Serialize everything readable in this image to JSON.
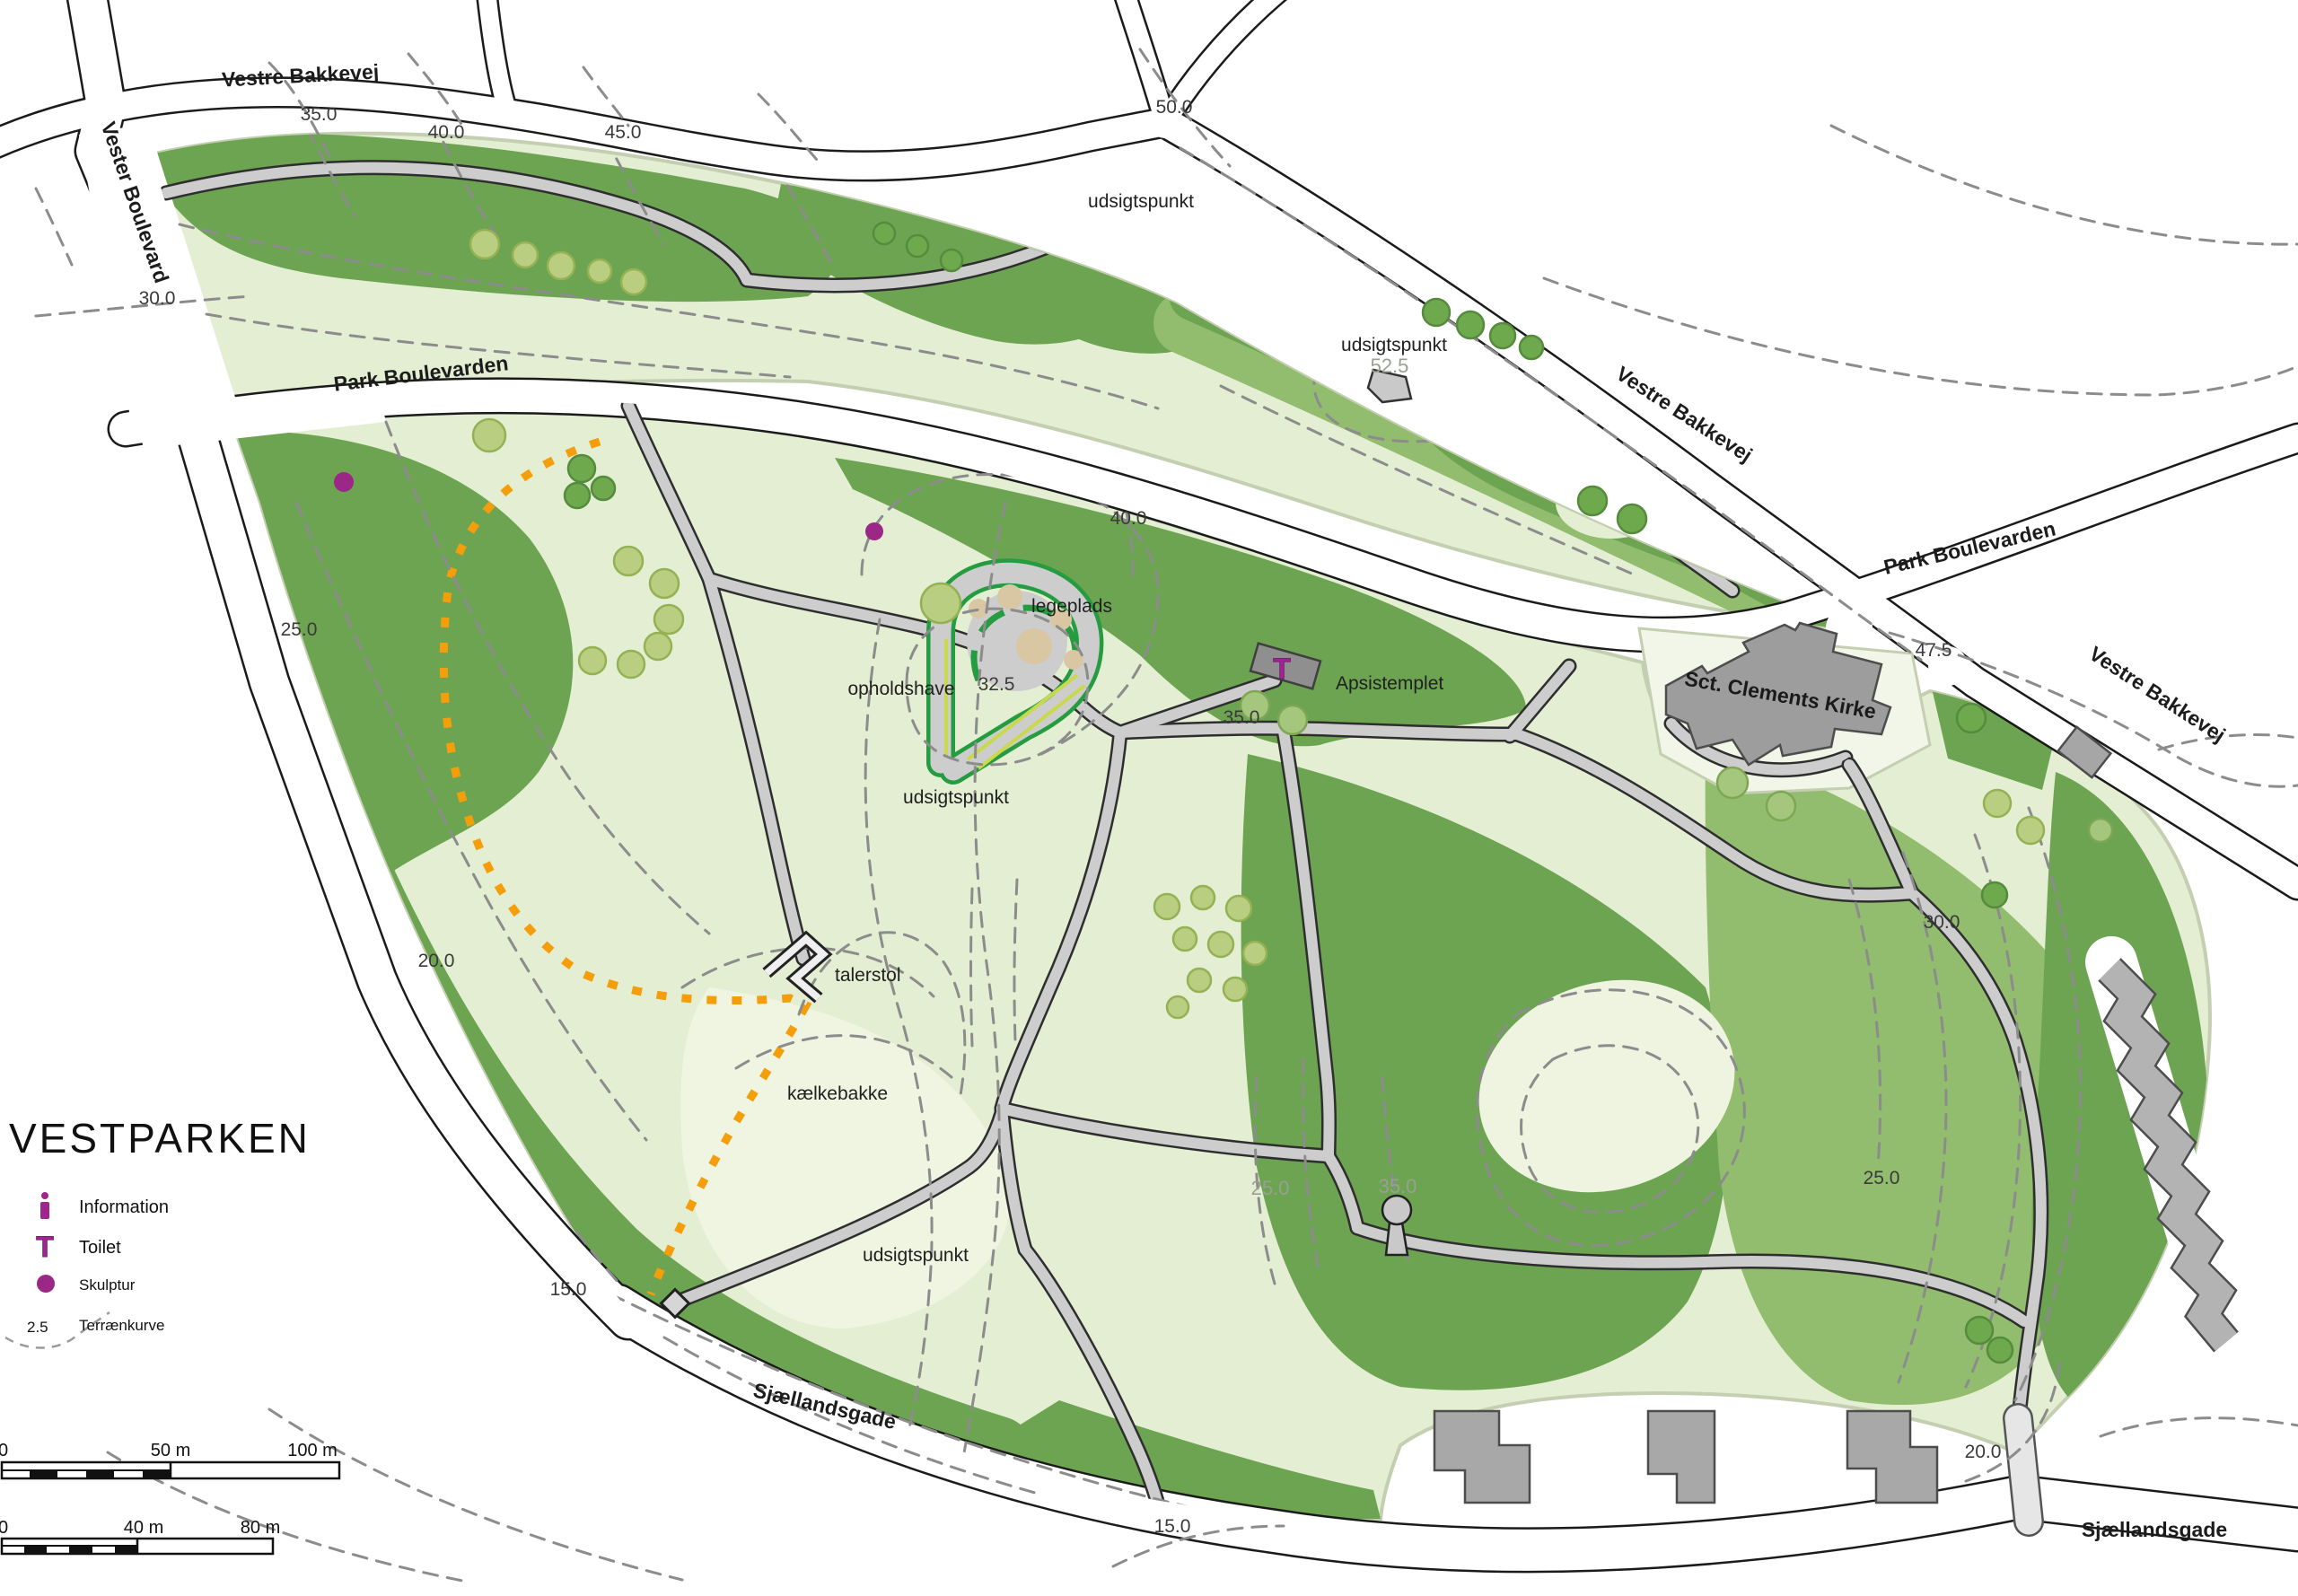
{
  "title": "VESTPARKEN",
  "legend": {
    "items": [
      {
        "icon": "information-icon",
        "label": "Information"
      },
      {
        "icon": "toilet-icon",
        "label": "Toilet"
      },
      {
        "icon": "sculpture-icon",
        "label": "Skulptur"
      },
      {
        "icon": "contour-icon",
        "label": "Terrænkurve",
        "value": "2.5"
      }
    ]
  },
  "scalebars": [
    {
      "start": "0",
      "mid": "50 m",
      "end": "100 m"
    },
    {
      "start": "0",
      "mid": "40 m",
      "end": "80 m"
    }
  ],
  "map": {
    "street_labels": [
      {
        "text": "Vestre Bakkevej"
      },
      {
        "text": "Vester Boulevard"
      },
      {
        "text": "Park Boulevarden"
      },
      {
        "text": "Vestre Bakkevej"
      },
      {
        "text": "Park Boulevarden"
      },
      {
        "text": "Vestre Bakkevej"
      },
      {
        "text": "Sjællandsgade"
      },
      {
        "text": "Sjællandsgade"
      },
      {
        "text": "Sct. Clements Kirke"
      }
    ],
    "contour_labels": [
      {
        "text": "35.0"
      },
      {
        "text": "40.0"
      },
      {
        "text": "45.0"
      },
      {
        "text": "50.0"
      },
      {
        "text": "30.0"
      },
      {
        "text": "25.0"
      },
      {
        "text": "20.0"
      },
      {
        "text": "15.0"
      },
      {
        "text": "40.0"
      },
      {
        "text": "32.5"
      },
      {
        "text": "35.0"
      },
      {
        "text": "47.5"
      },
      {
        "text": "30.0"
      },
      {
        "text": "25.0"
      },
      {
        "text": "20.0"
      },
      {
        "text": "15.0"
      }
    ],
    "contour_labels_gray": [
      {
        "text": "52.5"
      },
      {
        "text": "25.0"
      },
      {
        "text": "35.0"
      }
    ],
    "feature_labels": [
      {
        "text": "udsigtspunkt"
      },
      {
        "text": "udsigtspunkt"
      },
      {
        "text": "legeplads"
      },
      {
        "text": "opholdshave"
      },
      {
        "text": "udsigtspunkt"
      },
      {
        "text": "Apsistemplet"
      },
      {
        "text": "talerstol"
      },
      {
        "text": "kælkebakke"
      },
      {
        "text": "udsigtspunkt"
      }
    ],
    "toilet_glyph": "T",
    "colors": {
      "park_light": "#e4eed3",
      "park_pale": "#f0f5e2",
      "park_mid": "#92bc6e",
      "park_dark": "#6da452",
      "path_gray": "#cdcdcd",
      "hedge_green": "#259c3f",
      "hedge_yellow": "#c9d94e",
      "route_orange": "#f59e0b",
      "marker_purple": "#9b2786",
      "sand": "#d9c7a4",
      "building_gray": "#a8a8a8"
    }
  }
}
